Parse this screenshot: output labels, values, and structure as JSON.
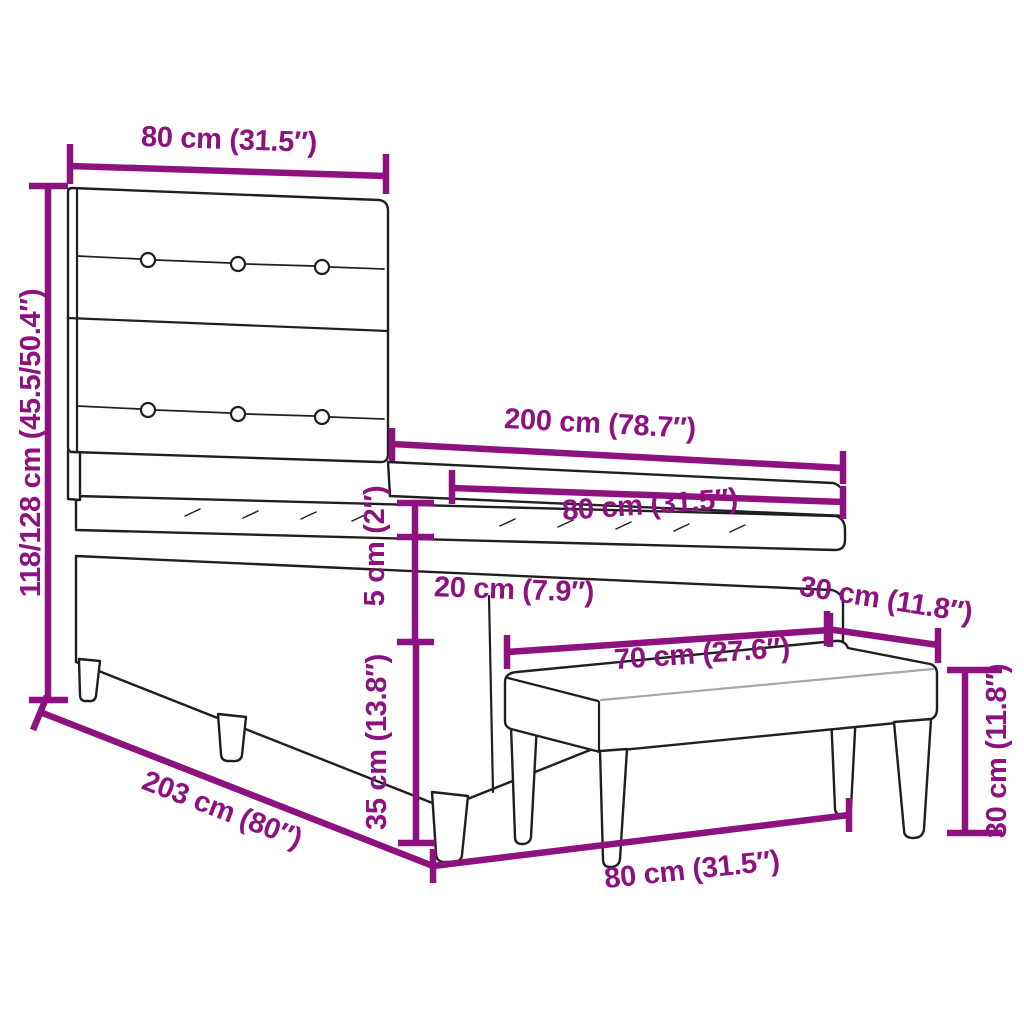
{
  "title": "Box spring bed with bench dimension diagram",
  "colors": {
    "dimension": "#8e1180",
    "outline": "#1f1f1f",
    "soft_edge": "#a8a8a8",
    "background": "#ffffff"
  },
  "dimensions": {
    "headboard_width": {
      "label": "80 cm (31.5″)"
    },
    "bed_height": {
      "label": "118/128 cm (45.5/50.4″)"
    },
    "bed_length": {
      "label": "200 cm (78.7″)"
    },
    "mattress_width": {
      "label": "80 cm (31.5″)"
    },
    "mattress_height": {
      "label": "5 cm (2″)"
    },
    "base_height": {
      "label": "20 cm (7.9″)"
    },
    "bench_depth": {
      "label": "30 cm (11.8″)"
    },
    "bench_seat_length": {
      "label": "70 cm (27.6″)"
    },
    "bed_leg_height": {
      "label": "35 cm (13.8″)"
    },
    "bed_frame_length": {
      "label": "203 cm (80″)"
    },
    "bench_length": {
      "label": "80 cm (31.5″)"
    },
    "bench_height": {
      "label": "30 cm (11.8″)"
    }
  }
}
